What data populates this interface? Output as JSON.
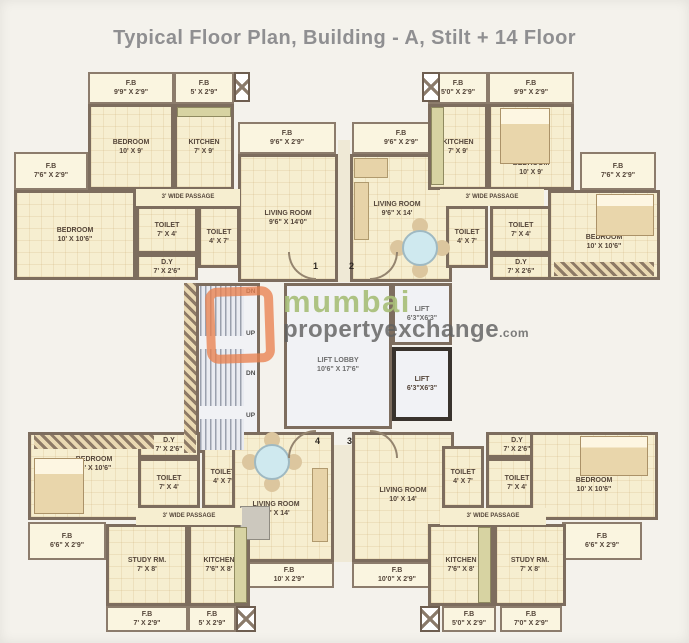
{
  "title": "Typical Floor Plan, Building - A, Stilt + 14 Floor",
  "watermark": {
    "brand_top": "mumbai",
    "brand_bottom": "propertyexchange",
    "brand_suffix": ".com"
  },
  "colors": {
    "wall": "#7d6d5e",
    "room_fill": "#f6eed0",
    "balcony_fill": "#faf5e0",
    "core_fill": "#f1f2f5",
    "title_text": "#8f8f91",
    "watermark_orange": "#e9824f",
    "watermark_green": "#a8bf78",
    "watermark_gray": "#606060"
  },
  "units": {
    "unit1": {
      "fb_bedroom": {
        "name": "F.B",
        "dims": "9'9\" X 2'9\""
      },
      "fb_kitchen": {
        "name": "F.B",
        "dims": "5' X 2'9\""
      },
      "bedroom_top": {
        "name": "BEDROOM",
        "dims": "10' X 9'"
      },
      "kitchen": {
        "name": "KITCHEN",
        "dims": "7' X 9'"
      },
      "fb_side": {
        "name": "F.B",
        "dims": "7'6\" X 2'9\""
      },
      "bedroom_side": {
        "name": "BEDROOM",
        "dims": "10' X 10'6\""
      },
      "passage": {
        "name": "3' WIDE PASSAGE"
      },
      "toilet_a": {
        "name": "TOILET",
        "dims": "7' X 4'"
      },
      "toilet_b": {
        "name": "TOILET",
        "dims": "4' X 7'"
      },
      "dry_yard": {
        "name": "D.Y",
        "dims": "7' X 2'6\""
      },
      "fb_living": {
        "name": "F.B",
        "dims": "9'6\" X 2'9\""
      },
      "living": {
        "name": "LIVING ROOM",
        "dims": "9'6\" X 14'0\""
      }
    },
    "unit2": {
      "fb_living": {
        "name": "F.B",
        "dims": "9'6\" X 2'9\""
      },
      "living": {
        "name": "LIVING ROOM",
        "dims": "9'6\" X 14'"
      },
      "fb_kitchen": {
        "name": "F.B",
        "dims": "5'0\" X 2'9\""
      },
      "kitchen": {
        "name": "KITCHEN",
        "dims": "7' X 9'"
      },
      "fb_bedroom": {
        "name": "F.B",
        "dims": "9'9\" X 2'9\""
      },
      "bedroom_top": {
        "name": "BEDROOM",
        "dims": "10' X 9'"
      },
      "fb_side": {
        "name": "F.B",
        "dims": "7'6\" X 2'9\""
      },
      "passage": {
        "name": "3' WIDE PASSAGE"
      },
      "toilet_a": {
        "name": "TOILET",
        "dims": "4' X 7'"
      },
      "toilet_b": {
        "name": "TOILET",
        "dims": "7' X 4'"
      },
      "dry_yard": {
        "name": "D.Y",
        "dims": "7' X 2'6\""
      },
      "bedroom_side": {
        "name": "BEDROOM",
        "dims": "10' X 10'6\""
      }
    },
    "unit3": {
      "living": {
        "name": "LIVING ROOM",
        "dims": "10' X 14'"
      },
      "fb_living": {
        "name": "F.B",
        "dims": "10'0\" X 2'9\""
      },
      "dry_yard": {
        "name": "D.Y",
        "dims": "7' X 2'6\""
      },
      "toilet_a": {
        "name": "TOILET",
        "dims": "4' X 7'"
      },
      "toilet_b": {
        "name": "TOILET",
        "dims": "7' X 4'"
      },
      "bedroom_side": {
        "name": "BEDROOM",
        "dims": "10' X 10'6\""
      },
      "passage": {
        "name": "3' WIDE PASSAGE"
      },
      "fb_side": {
        "name": "F.B",
        "dims": "6'6\" X 2'9\""
      },
      "study": {
        "name": "STUDY RM.",
        "dims": "7' X 8'"
      },
      "kitchen": {
        "name": "KITCHEN",
        "dims": "7'6\" X 8'"
      },
      "fb_kitchen": {
        "name": "F.B",
        "dims": "5'0\" X 2'9\""
      },
      "fb_study": {
        "name": "F.B",
        "dims": "7'0\" X 2'9\""
      }
    },
    "unit4": {
      "bedroom_side": {
        "name": "BEDROOM",
        "dims": "10' X 10'6\""
      },
      "dry_yard": {
        "name": "D.Y",
        "dims": "7' X 2'6\""
      },
      "toilet_a": {
        "name": "TOILET",
        "dims": "7' X 4'"
      },
      "toilet_b": {
        "name": "TOILET",
        "dims": "4' X 7'"
      },
      "living": {
        "name": "LIVING ROOM",
        "dims": "10' X 14'"
      },
      "passage": {
        "name": "3' WIDE PASSAGE"
      },
      "fb_side": {
        "name": "F.B",
        "dims": "6'6\" X 2'9\""
      },
      "study": {
        "name": "STUDY RM.",
        "dims": "7' X 8'"
      },
      "kitchen": {
        "name": "KITCHEN",
        "dims": "7'6\" X 8'"
      },
      "fb_study": {
        "name": "F.B",
        "dims": "7' X 2'9\""
      },
      "fb_kitchen": {
        "name": "F.B",
        "dims": "5' X 2'9\""
      },
      "fb_living": {
        "name": "F.B",
        "dims": "10' X 2'9\""
      }
    }
  },
  "core": {
    "lift_lobby": {
      "name": "LIFT LOBBY",
      "dims": "10'6\" X 17'6\""
    },
    "lift_upper": {
      "name": "LIFT",
      "dims": "6'3\"X6'3\""
    },
    "lift_lower": {
      "name": "LIFT",
      "dims": "6'3\"X6'3\""
    },
    "stairs": {
      "dn_upper": "DN",
      "up_upper": "UP",
      "dn_lower": "DN",
      "up_lower": "UP"
    },
    "flat_numbers": {
      "f1": "1",
      "f2": "2",
      "f3": "3",
      "f4": "4"
    }
  }
}
